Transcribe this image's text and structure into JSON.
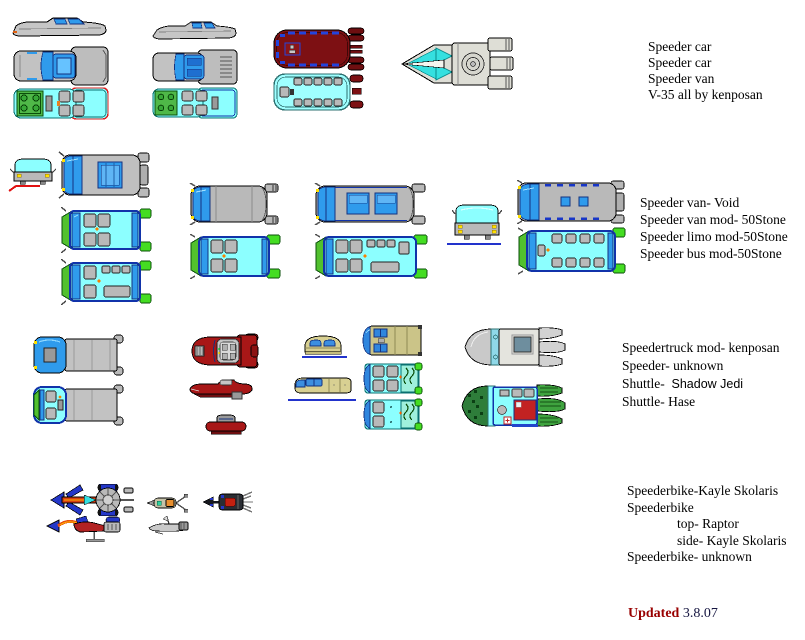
{
  "palette": {
    "background": "#FFFFFF",
    "hull_gray": "#BFBFBF",
    "window_blue": "#2F9BEC",
    "navy_trim": "#14327F",
    "interior_cyan": "#8CFFFF",
    "engine_green": "#4FB848",
    "pod_green": "#44DD22",
    "van_maroon": "#7D1013",
    "speeder_red": "#A81717",
    "shuttle_khaki": "#CBC488",
    "hase_green": "#2E7D3A",
    "bike_blue": "#2437C8",
    "accent_orange": "#E85010",
    "accent_yellow": "#FFE000",
    "ground_line_blue": "#2233CC",
    "ground_line_red": "#E11111",
    "updated_red": "#990000",
    "text_black": "#000000"
  },
  "captions": {
    "group1": {
      "lines": [
        "Speeder car",
        "Speeder car",
        "Speeder van",
        "V-35  all by kenposan"
      ]
    },
    "group2": {
      "lines": [
        "Speeder van- Void",
        "Speeder van mod- 50Stone",
        "Speeder limo mod-50Stone",
        "Speeder bus mod-50Stone"
      ]
    },
    "group3": {
      "line1": "Speedertruck mod- kenposan",
      "line2": "Speeder- unknown",
      "line3_prefix": "Shuttle-",
      "line3_name": "Shadow Jedi",
      "line4": "Shuttle- Hase"
    },
    "group4": {
      "lines": [
        "Speederbike-Kayle Skolaris",
        "Speederbike",
        "top- Raptor",
        "side- Kayle Skolaris",
        "Speederbike- unknown"
      ]
    },
    "footer": {
      "updated_label": "Updated",
      "date": "3.8.07"
    }
  },
  "sprite_names": [
    "speeder-car-1-side-view",
    "speeder-car-1-top-view",
    "speeder-car-1-interior-view",
    "speeder-car-2-side-view",
    "speeder-car-2-top-view",
    "speeder-car-2-interior-view",
    "speeder-van-maroon-top-view",
    "speeder-van-maroon-interior-view",
    "v-35-landspeeder-top-view",
    "speeder-van-void-front-view",
    "speeder-van-void-top-view",
    "speeder-van-void-interior-1",
    "speeder-van-void-interior-2",
    "speeder-van-mod-top-view",
    "speeder-van-mod-interior",
    "speeder-limo-top-view",
    "speeder-limo-interior",
    "speeder-bus-front-view",
    "speeder-bus-top-view",
    "speeder-bus-interior",
    "speedertruck-top-view",
    "speedertruck-interior",
    "speeder-unknown-top-view",
    "speeder-unknown-side-view",
    "speeder-unknown-front-view",
    "shuttle-shadow-jedi-front-view",
    "shuttle-shadow-jedi-side-view",
    "shuttle-shadow-jedi-top-view",
    "shuttle-shadow-jedi-interior-1",
    "shuttle-shadow-jedi-interior-2",
    "shuttle-hase-top-view",
    "shuttle-hase-interior",
    "speederbike-kayle-skolaris-top-view",
    "speederbike-kayle-skolaris-side-view",
    "speederbike-raptor-top-view",
    "speederbike-raptor-side-view",
    "speederbike-unknown-top-view"
  ]
}
